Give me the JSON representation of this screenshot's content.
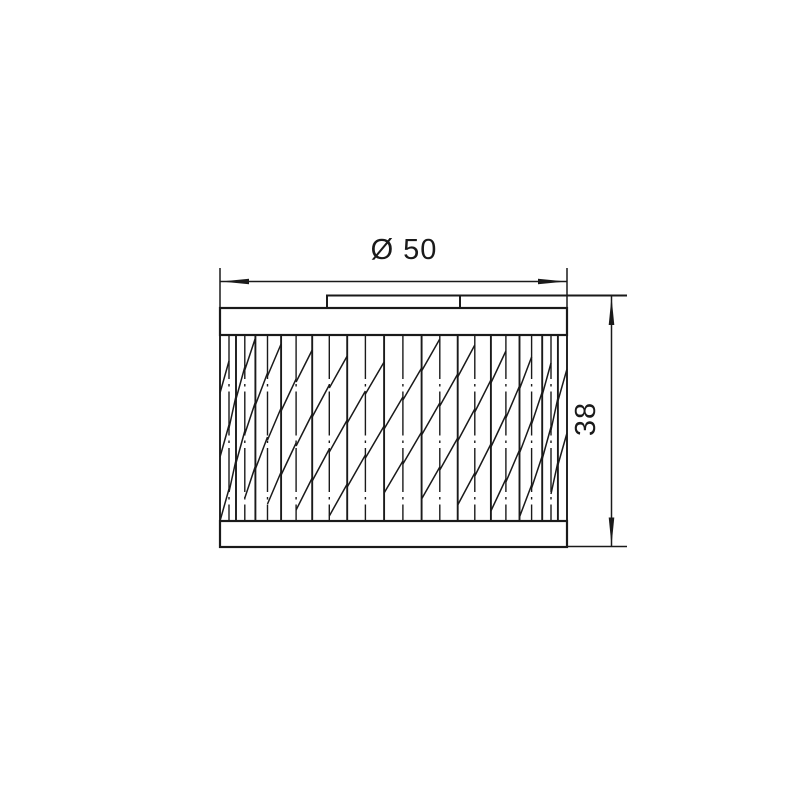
{
  "drawing": {
    "type": "technical-line-drawing",
    "subject": "cylindrical pleated filter element, front view",
    "dimensions": {
      "diameter_label": "Ø 50",
      "height_label": "38"
    },
    "colors": {
      "background": "#ffffff",
      "line": "#1a1a1a"
    }
  }
}
